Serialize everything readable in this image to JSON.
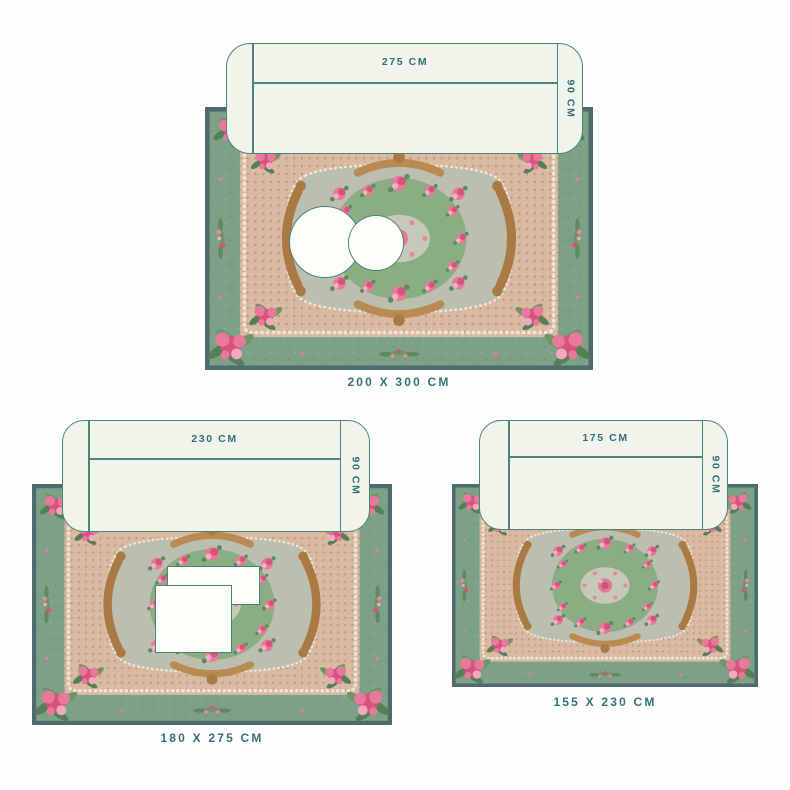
{
  "page": {
    "title": "Rug size guide",
    "background": "#fefefe"
  },
  "colors": {
    "accent_teal_text": "#35707a",
    "outline_teal": "#4a8578",
    "sofa_fill": "#f0f4ea",
    "table_fill": "#fcfef8",
    "rug_edge": "#4e6c6e",
    "rug_border_green": "#7da187",
    "rug_field_beige": "#d9b9a1",
    "rug_cartouche_gray": "#bcbfaf",
    "rug_center_green": "#8bad83",
    "rug_flower_pink": "#e8799a"
  },
  "sections": [
    {
      "name": "large-rug",
      "rug_label": "200 X 300 CM",
      "sofa_width_label": "275 CM",
      "sofa_depth_label": "90 CM"
    },
    {
      "name": "medium-rug",
      "rug_label": "180 X 275 CM",
      "sofa_width_label": "230 CM",
      "sofa_depth_label": "90 CM"
    },
    {
      "name": "small-rug",
      "rug_label": "155 X 230 CM",
      "sofa_width_label": "175 CM",
      "sofa_depth_label": "90 CM"
    }
  ]
}
